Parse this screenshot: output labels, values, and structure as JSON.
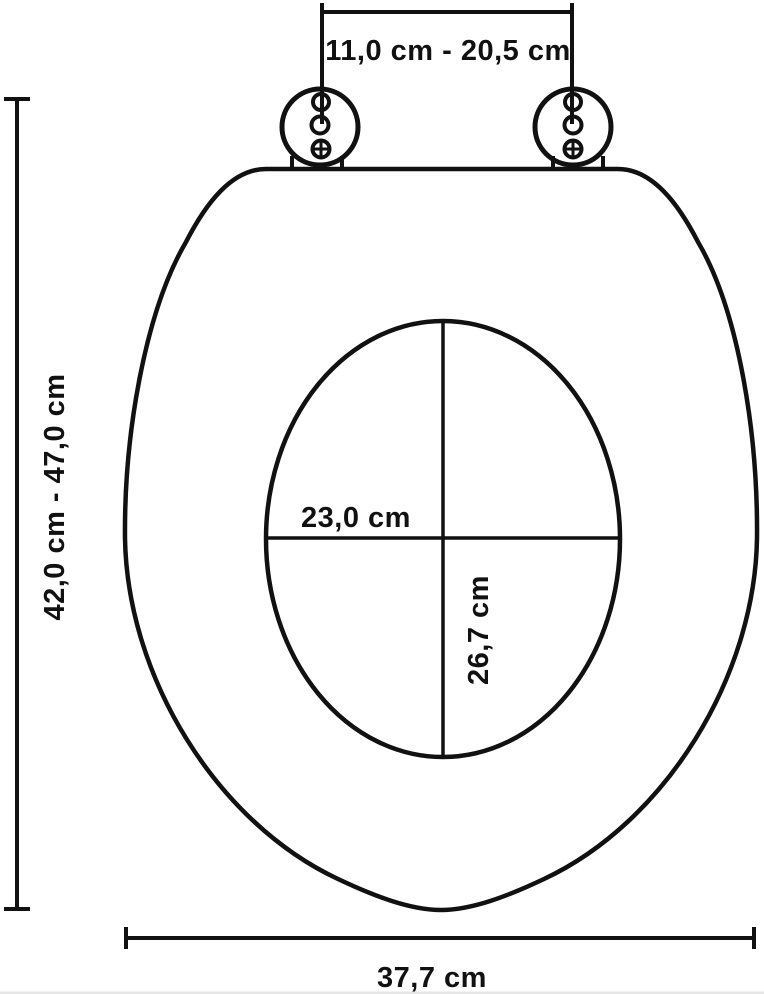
{
  "diagram": {
    "type": "technical-dimension-drawing",
    "subject": "toilet-seat-top-view",
    "background_color": "#ffffff",
    "line_color": "#111111",
    "labels": {
      "hinge_spacing": "11,0 cm - 20,5 cm",
      "overall_length": "42,0 cm - 47,0 cm",
      "overall_width": "37,7 cm",
      "opening_width": "23,0 cm",
      "opening_length": "26,7 cm"
    }
  }
}
